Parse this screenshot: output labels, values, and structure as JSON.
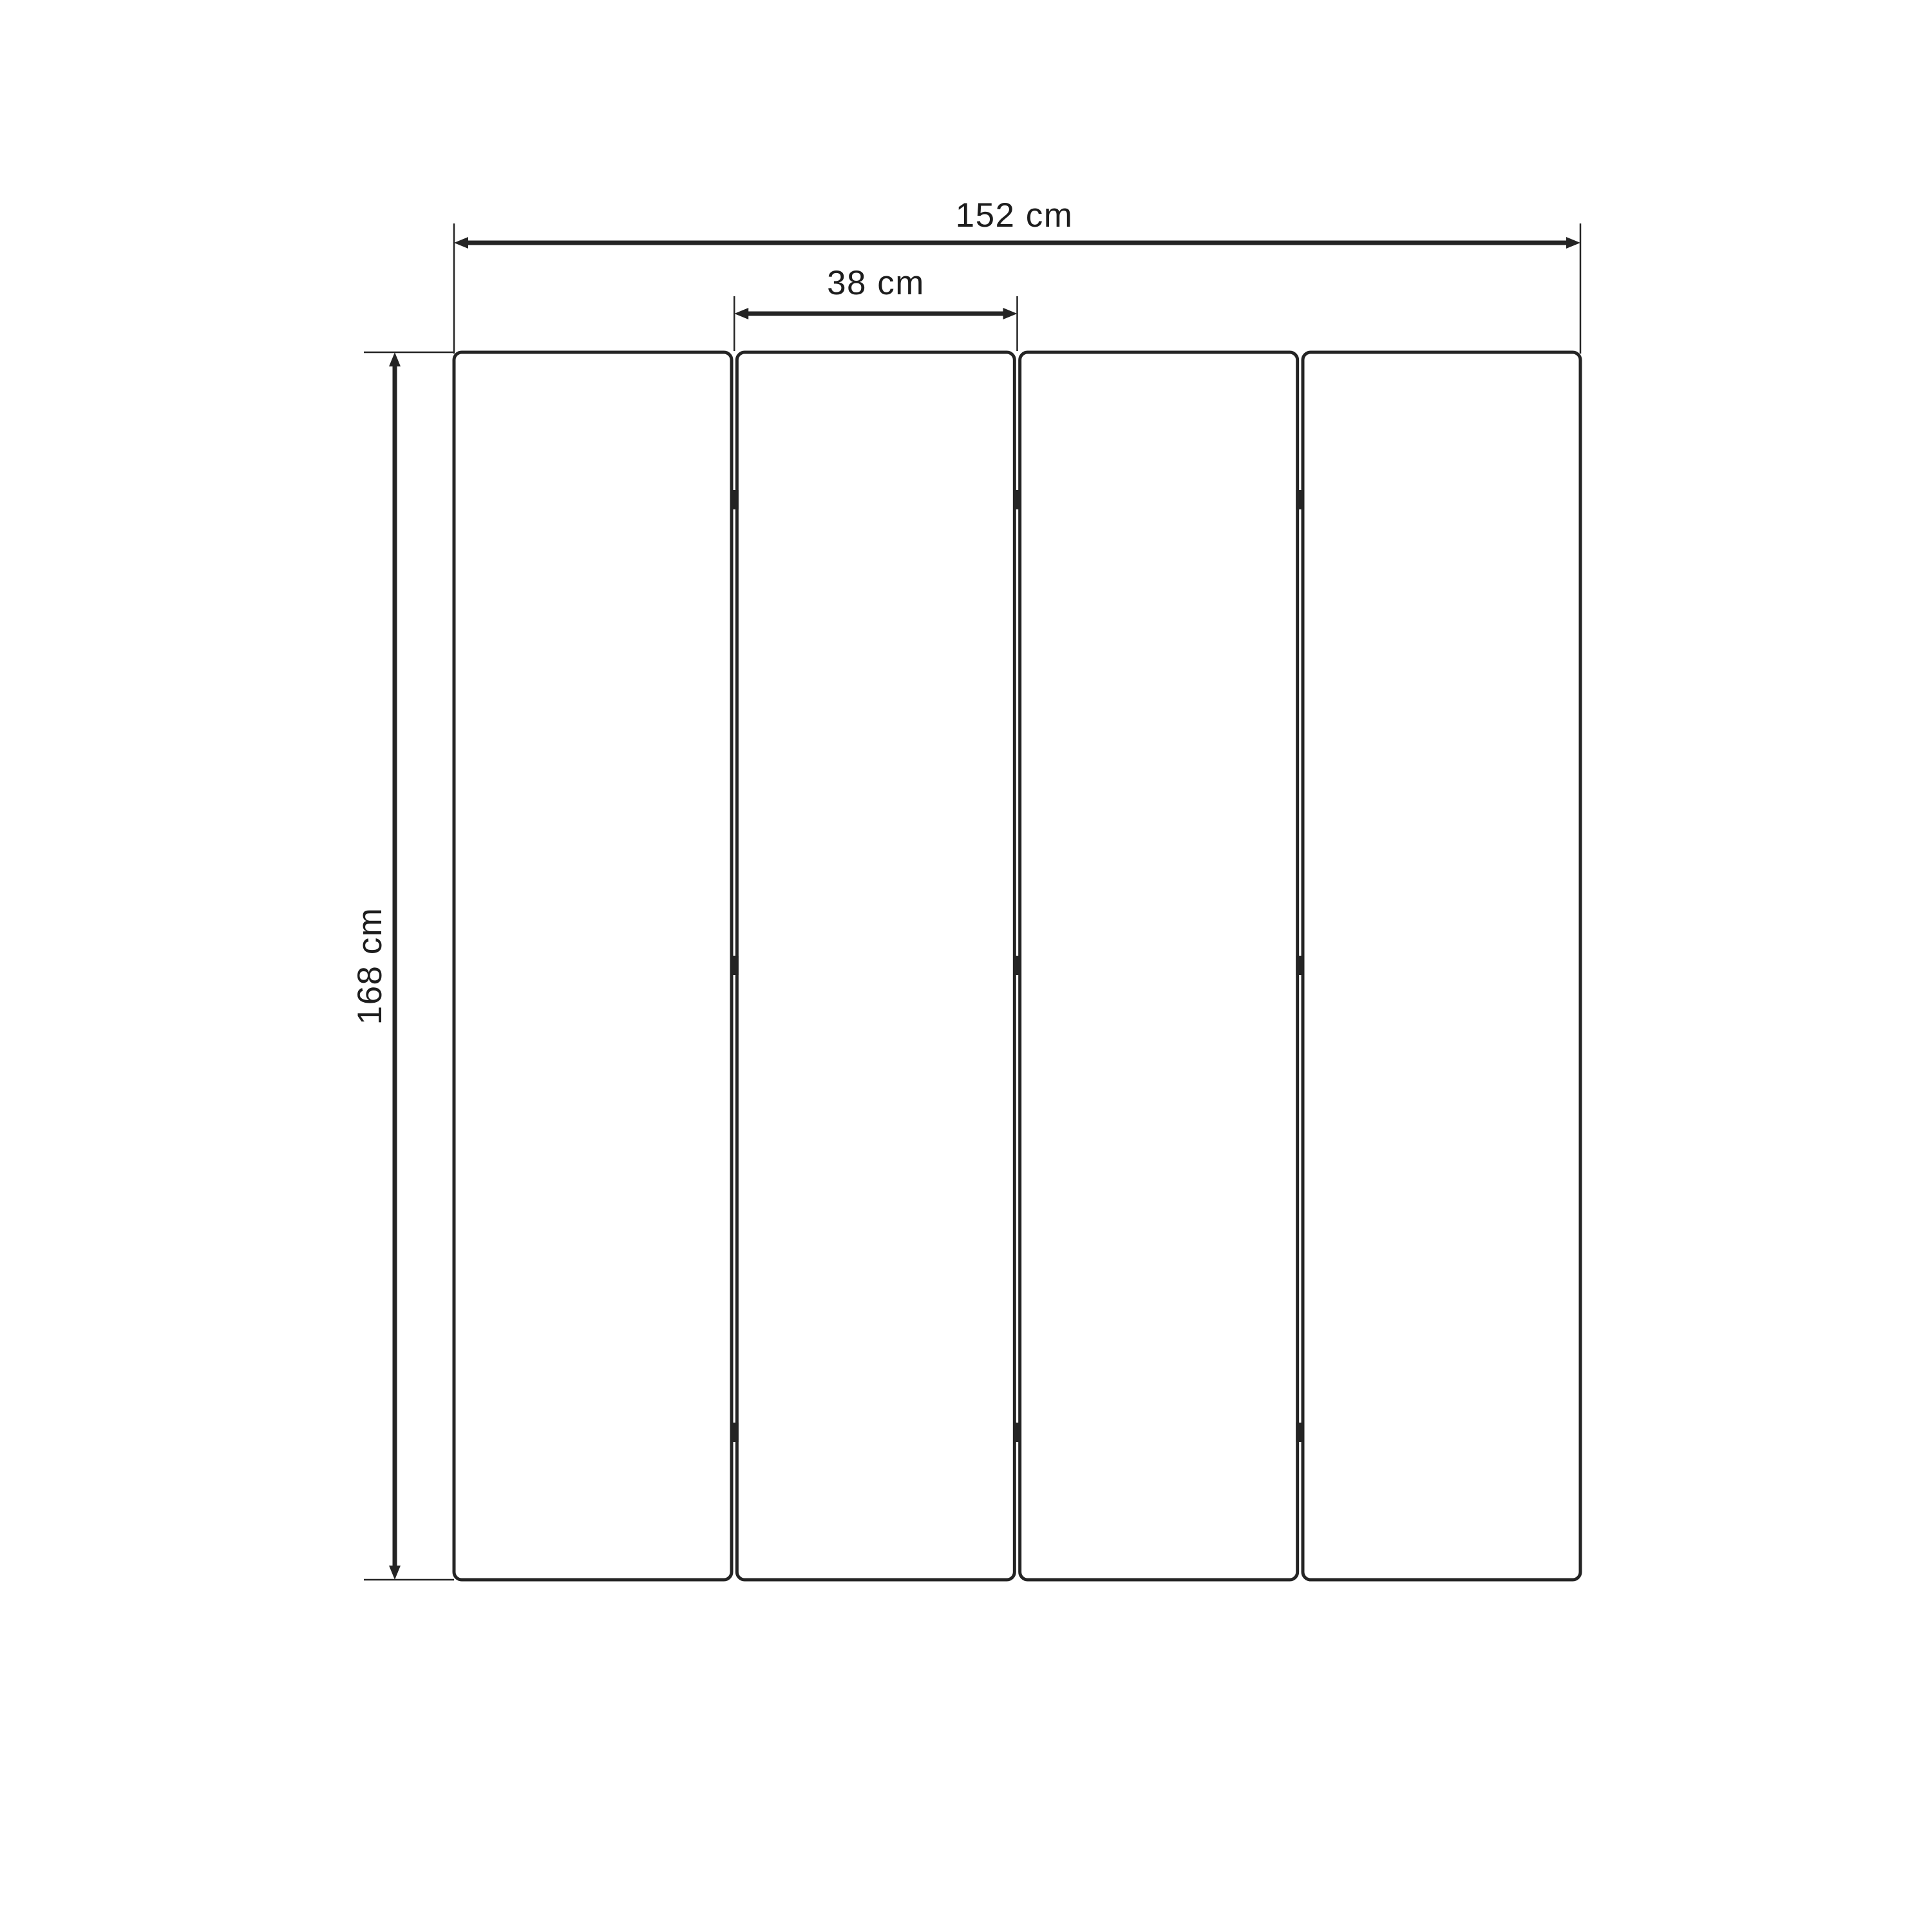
{
  "diagram": {
    "labels": {
      "total_width": "152 cm",
      "panel_width": "38 cm",
      "height": "168 cm"
    },
    "values": {
      "total_width_cm": 152,
      "panel_width_cm": 38,
      "height_cm": 168,
      "panel_count": 4,
      "unit": "cm"
    },
    "colors": {
      "line": "#242424",
      "text": "#1d1d1d",
      "background": "#ffffff"
    }
  }
}
